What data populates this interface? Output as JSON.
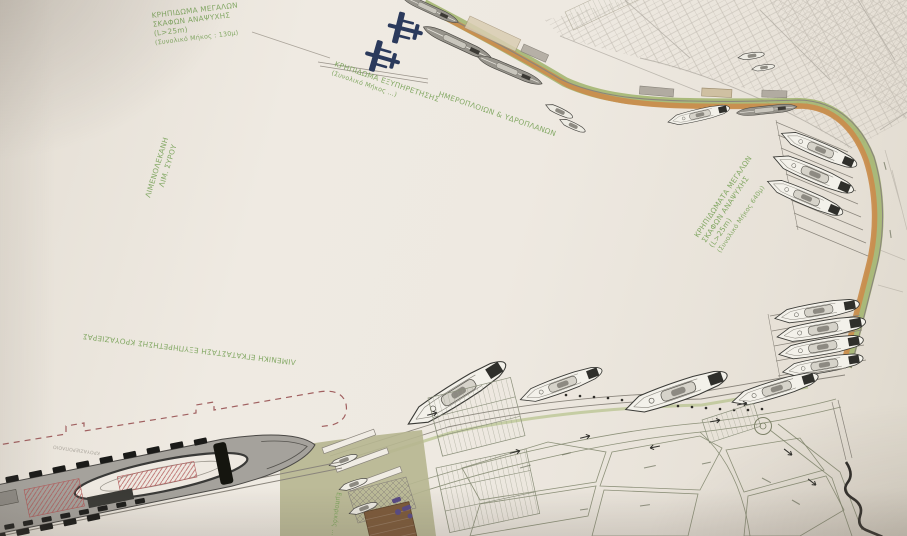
{
  "plan": {
    "labels": {
      "north_quay": {
        "line1": "ΚΡΗΠΙΔΩΜΑ ΜΕΓΑΛΩΝ",
        "line2": "ΣΚΑΦΩΝ ΑΝΑΨΥΧΗΣ",
        "line3": "(L>25m)",
        "line4": "(Συνολικό Μήκος : 130μ)"
      },
      "seaplane_quay": {
        "line1": "ΚΡΗΠΙΔΩΜΑ ΕΞΥΠΗΡΕΤΗΣΗΣ",
        "line2": "(Συνολικό Μήκος …)",
        "line3": "ΗΜΕΡΟΠΛΟΙΩΝ & ΥΔΡΟΠΛΑΝΩΝ"
      },
      "basin": {
        "line1": "ΛΙΜΕΝΟΛΕΚΑΝΗ",
        "line2": "ΛΙΜ. ΣΥΡΟΥ"
      },
      "east_quay": {
        "line1": "ΚΡΗΠΙΔΩΜΑΤΑ ΜΕΓΑΛΩΝ",
        "line2": "ΣΚΑΦΩΝ ΑΝΑΨΥΧΗΣ",
        "line3": "(L>25m)",
        "line4": "(Συνολικό Μήκος 640μ)"
      },
      "cruise_terminal": "ΛΙΜΕΝΙΚΗ ΕΓΚΑΤΑΣΤΑΣΗ ΕΞΥΠΗΡΕΤΗΣΗΣ ΚΡΟΥΑΖΙΕΡΑΣ",
      "cruise_ship": "ΚΡΟΥΑΖΙΕΡΟΠΛΟΙΟ",
      "commercial_area": "Εμπορικός …"
    },
    "colors": {
      "paper": "#ece7df",
      "label_green": "#7aa35a",
      "road_orange": "#c98d4e",
      "landscape_green": "#9fb36a",
      "seaplane_navy": "#2b3a5c",
      "boundary_dashed_red": "#a06060",
      "line_gray": "#8a857c",
      "olive_land": "#b6b690",
      "pier_brown": "#7d5a3a"
    }
  }
}
